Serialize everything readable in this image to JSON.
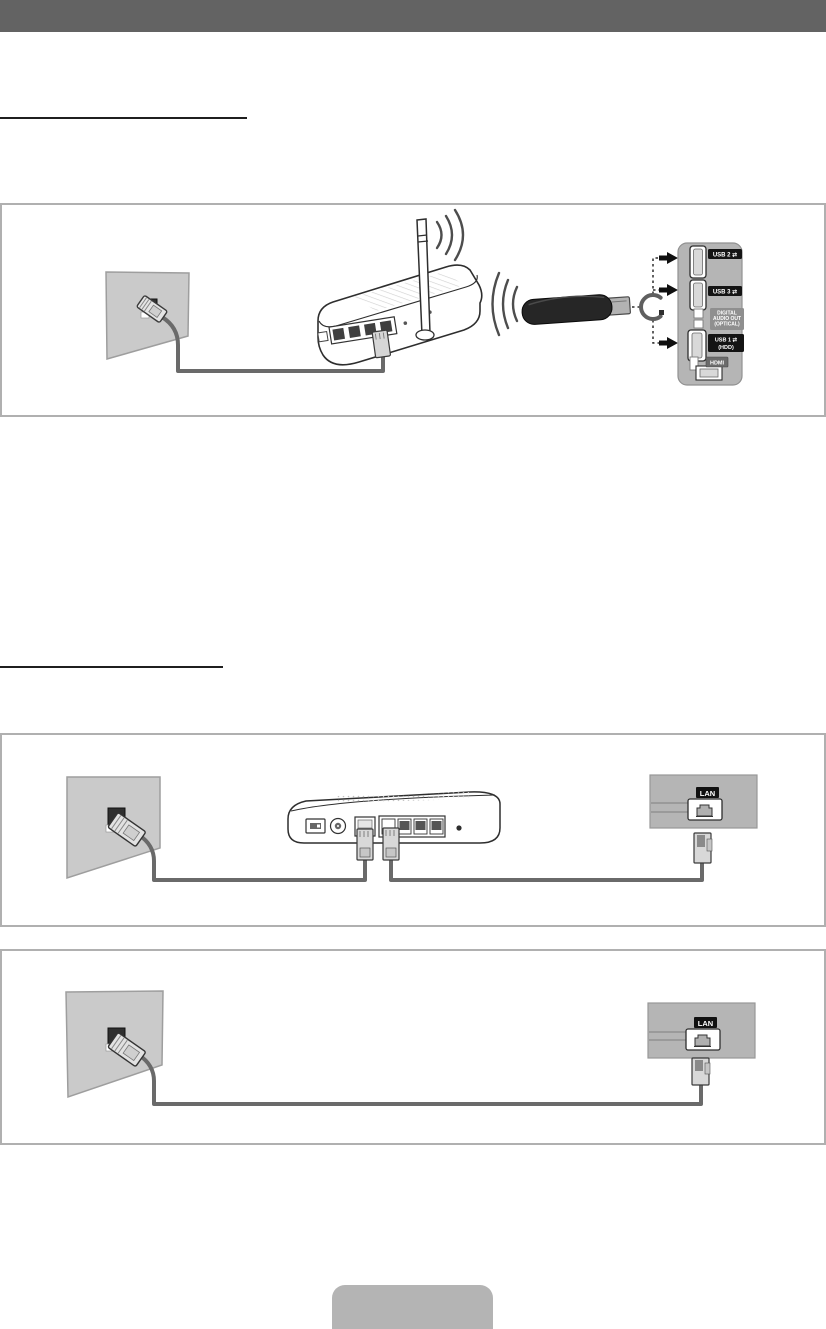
{
  "page": {
    "kind": "tv-manual-network-connection-page",
    "sections": [
      {
        "id": "wireless-network",
        "heading_text_visible": ""
      },
      {
        "id": "wired-network",
        "heading_text_visible": ""
      }
    ]
  },
  "diagrams": {
    "wireless": {
      "tv_panel": {
        "usb2": "USB 2 ⇄",
        "usb3": "USB 3 ⇄",
        "audio1": "DIGITAL",
        "audio2": "AUDIO OUT",
        "audio3": "(OPTICAL)",
        "usb1": "USB 1 ⇄",
        "usb1_sub": "(HDD)",
        "hdmi": "HDMI"
      }
    },
    "wired_router": {
      "lan_label": "LAN"
    },
    "wired_direct": {
      "lan_label": "LAN"
    }
  },
  "footer": {
    "button_label": ""
  },
  "colors": {
    "header_bar": "#636363",
    "box_border": "#b0b0b0",
    "wall_gray": "#cacaca",
    "tv_panel_gray": "#b5b5b5",
    "cable_gray": "#6a6a6a",
    "port_badge_black": "#141414",
    "audio_badge_gray": "#8f8f8f",
    "footer_button_gray": "#b4b4b4"
  }
}
